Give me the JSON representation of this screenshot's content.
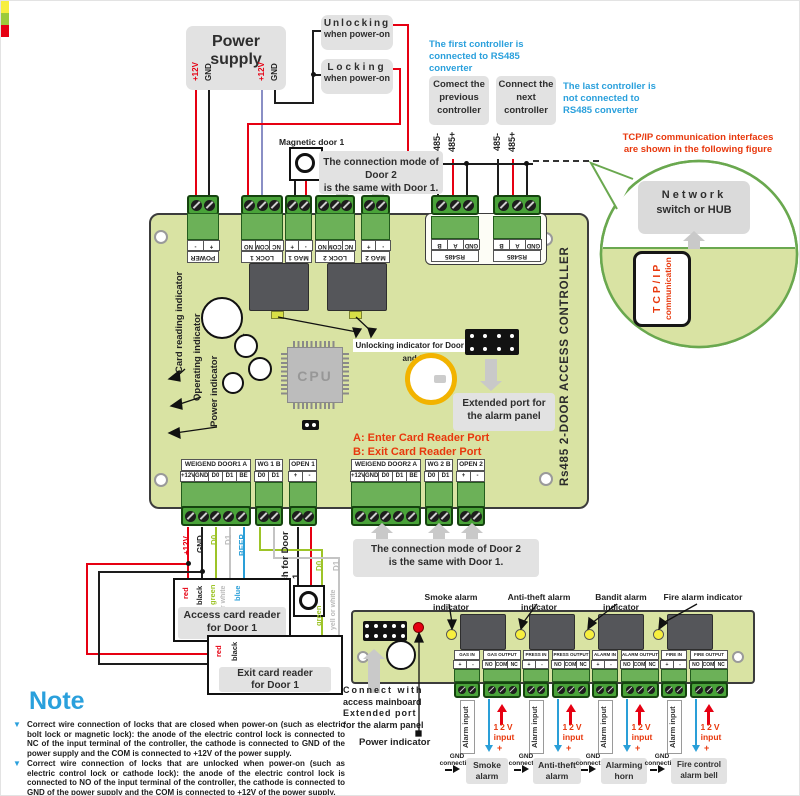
{
  "colors": {
    "board_green": "#d9e3a3",
    "terminal_green": "#49a339",
    "wire_red": "#e60012",
    "wire_black": "#1d1d1d",
    "wire_blue": "#2a9fd8",
    "wire_green": "#9dc428",
    "wire_white": "#c4c4c4",
    "wire_violet": "#8a8fc5",
    "note_blue": "#2aa0dc",
    "accent_red": "#e8380d"
  },
  "power_supply": {
    "title": "Power supply",
    "pins": [
      "+12V",
      "GND",
      "+12V",
      "GND"
    ]
  },
  "lock_boxes": {
    "unlocking_line1": "Unlocking",
    "unlocking_line2": "when power-on",
    "locking_line1": "Locking",
    "locking_line2": "when power-on"
  },
  "magnetic_door_label": "Magnetic door 1",
  "door2_note": {
    "line1": "The connection mode of Door 2",
    "line2": "is the same with Door 1."
  },
  "controllers": {
    "first_note": "The first controller is  connected  to RS485 converter",
    "prev_box": "Comect the previous controller",
    "next_box": "Connect the next controller",
    "last_note": "The  last  controller is not connected to RS485 converter",
    "pin_minus": "485-",
    "pin_plus": "485+"
  },
  "tcpip_note": {
    "line1": "TCP/IP communication interfaces",
    "line2": "are shown in the following figure"
  },
  "balloon": {
    "network_line1": "Network",
    "network_line2": "switch or HUB",
    "tcp_line1": "T C P / I P",
    "tcp_line2": "communication"
  },
  "board": {
    "title": "Rs485 2-DOOR ACCESS CONTROLLER",
    "cpu": "CPU",
    "top_terminals": [
      {
        "name": "POWER",
        "pins": [
          "+",
          "-"
        ]
      },
      {
        "name": "LOCK 1",
        "pins": [
          "NC",
          "COM",
          "NO"
        ]
      },
      {
        "name": "MAG 1",
        "pins": [
          "-",
          "+"
        ]
      },
      {
        "name": "LOCK 2",
        "pins": [
          "NC",
          "COM",
          "NO"
        ]
      },
      {
        "name": "MAG 2",
        "pins": [
          "-",
          "+"
        ]
      }
    ],
    "rs485_terminals": [
      {
        "name": "RS485",
        "pins": [
          "GND",
          "A",
          "B"
        ]
      },
      {
        "name": "RS485",
        "pins": [
          "GND",
          "A",
          "B"
        ]
      }
    ],
    "indicators": [
      "Card reading indicator",
      "Operating indicator",
      "Power indicator"
    ],
    "unlock_indicator_note": "Unlocking indicator for Door 1 and 2",
    "reader_port_a": "A:  Enter Card Reader Port",
    "reader_port_b": "B:  Exit Card Reader Port",
    "extended_port_note_line1": "Extended port for",
    "extended_port_note_line2": "the alarm panel",
    "bottom_terminals": [
      {
        "name": "WEIGEND DOOR1  A",
        "pins": [
          "+12V",
          "GND",
          "D0",
          "D1",
          "BE"
        ]
      },
      {
        "name": "WG 1 B",
        "pins": [
          "D0",
          "D1"
        ]
      },
      {
        "name": "OPEN 1",
        "pins": [
          "+",
          "-"
        ]
      },
      {
        "name": "WEIGEND DOOR2  A",
        "pins": [
          "+12V",
          "GND",
          "D0",
          "D1",
          "BE"
        ]
      },
      {
        "name": "WG 2 B",
        "pins": [
          "D0",
          "D1"
        ]
      },
      {
        "name": "OPEN 2",
        "pins": [
          "+",
          "-"
        ]
      }
    ]
  },
  "door1_wiring": {
    "signal_labels": [
      "+12V",
      "GND",
      "D0",
      "D1",
      "BEEP"
    ],
    "color_labels": [
      "red",
      "black",
      "green",
      "yell or white",
      "blue"
    ],
    "wg_signal_labels": [
      "D0",
      "D1"
    ],
    "wg_color_labels": [
      "green",
      "yell or white"
    ],
    "exit_color_labels": [
      "red",
      "black"
    ],
    "access_reader_line1": "Access card reader",
    "access_reader_line2": "for Door 1",
    "exit_reader_line1": "Exit card reader",
    "exit_reader_line2": "for Door 1",
    "exit_switch": "Exit switch for Door 1"
  },
  "alarm_panel": {
    "indicator_labels": [
      "Smoke alarm indicator",
      "Anti-theft alarm indicator",
      "Bandit alarm indicator",
      "Fire alarm indicator"
    ],
    "groups": [
      {
        "in_name": "GAS IN",
        "out_name": "GAS OUTPUT",
        "label_line1": "Smoke",
        "label_line2": "alarm"
      },
      {
        "in_name": "PRESS IN",
        "out_name": "PRESS OUTPUT",
        "label_line1": "Anti-theft",
        "label_line2": "alarm"
      },
      {
        "in_name": "ALARM IN",
        "out_name": "ALARM OUTPUT",
        "label_line1": "Alarming",
        "label_line2": "horn"
      },
      {
        "in_name": "FIRE IN",
        "out_name": "FIRE OUTPUT",
        "label_line1": "Fire control",
        "label_line2": "alarm bell"
      }
    ],
    "in_pins": [
      "+",
      "-"
    ],
    "out_pins": [
      "NO",
      "COM",
      "NC"
    ],
    "alarm_input_label": "Alarm input",
    "v12_line1": "12V",
    "v12_line2": "input",
    "v12_plus": "+",
    "gnd_label": "GND connection",
    "connect_note_line1": "Connect with",
    "connect_note_line2": "access mainboard",
    "connect_note_line3": "Extended port",
    "connect_note_line4": "for the alarm panel",
    "power_indicator": "Power indicator"
  },
  "note": {
    "title": "Note",
    "bullets": [
      "Correct wire connection of locks that are closed when power-on (such as electric bolt lock or magnetic lock): the anode of the electric control lock is connected to NC of the input terminal of the controller, the cathode is connected to GND of the power supply and the COM is connected to +12V of the power supply.",
      "Correct wire connection of locks that are unlocked when power-on (such as electric control lock or cathode lock): the anode of the electric control lock is connected to NO of the input terminal of the controller, the cathode is connected to GND of the power supply and the COM is connected to +12V of the power supply."
    ]
  }
}
